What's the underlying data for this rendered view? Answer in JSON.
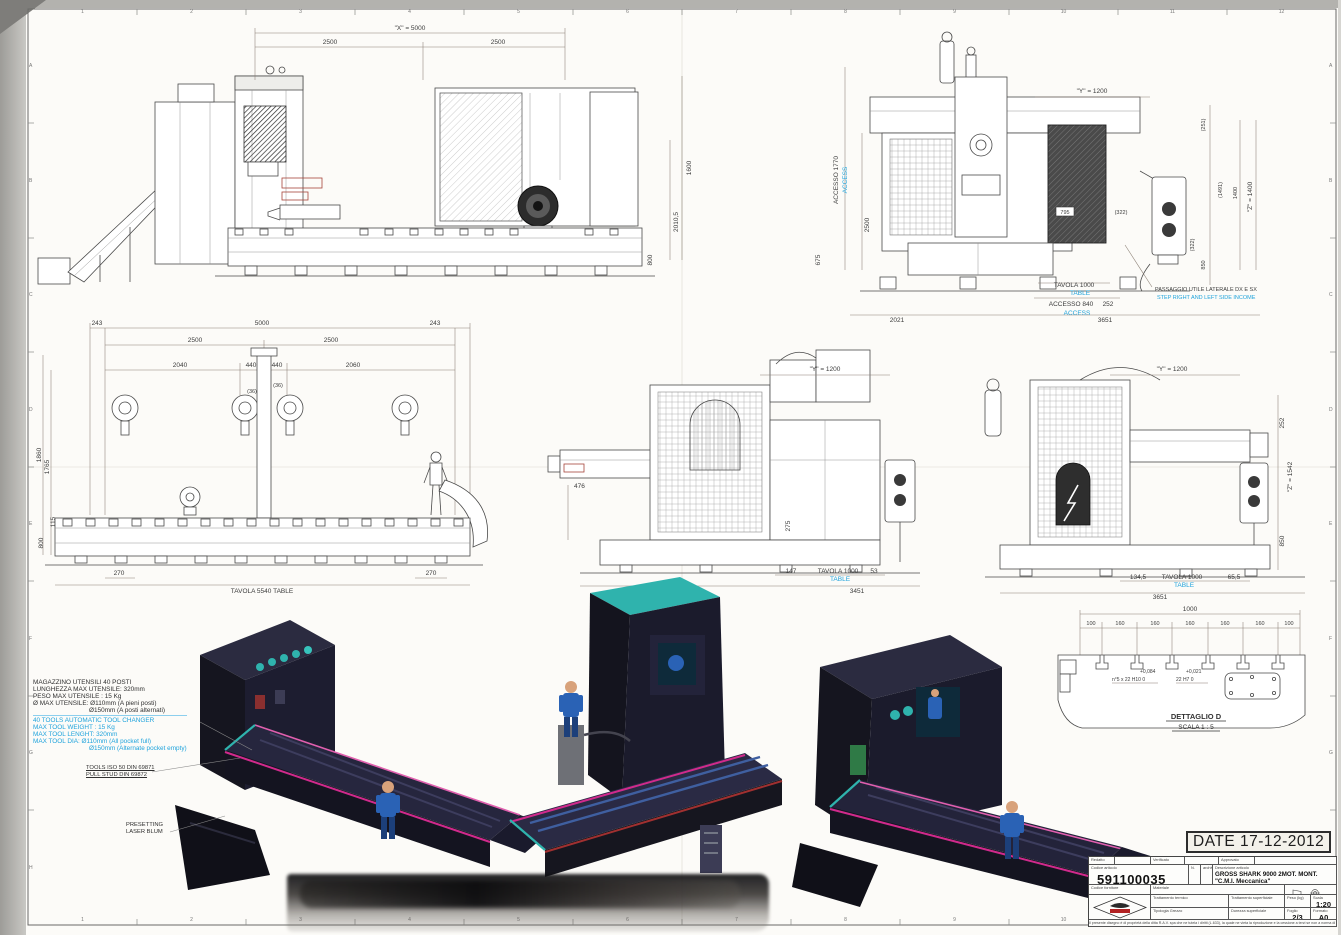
{
  "sheet": {
    "date_stamp": "DATE 17-12-2012",
    "zones_top": [
      "1",
      "2",
      "3",
      "4",
      "5",
      "6",
      "7",
      "8",
      "9",
      "10",
      "11",
      "12"
    ],
    "zones_bottom": [
      "1",
      "2",
      "3",
      "4",
      "5",
      "6",
      "7",
      "8",
      "9",
      "10",
      "11",
      "12"
    ],
    "zones_left": [
      "A",
      "B",
      "C",
      "D",
      "E",
      "F",
      "G",
      "H"
    ],
    "zones_right": [
      "A",
      "B",
      "C",
      "D",
      "E",
      "F",
      "G",
      "H"
    ]
  },
  "notes": {
    "magazine_it": [
      "MAGAZZINO UTENSILI 40 POSTI",
      "LUNGHEZZA MAX UTENSILE: 320mm",
      "PESO MAX UTENSILE : 15 Kg",
      "Ø MAX UTENSILE:  Ø110mm (A pieni posti)",
      "Ø150mm (A posti alternati)"
    ],
    "magazine_en": [
      "40 TOOLS AUTOMATIC TOOL CHANGER",
      "MAX TOOL  WEIGHT : 15 Kg",
      "MAX TOOL LENGHT: 320mm",
      "MAX TOOL DIA:  Ø110mm (All pocket full)",
      "Ø150mm (Alternate pocket empty)"
    ],
    "tools_iso": [
      "TOOLS ISO 50 DIN 69871",
      "PULL STUD DIN 69872"
    ],
    "presetting": [
      "PRESETTING",
      "LASER BLUM"
    ]
  },
  "view_tl": {
    "dim_total": "\"X\" = 5000",
    "dim_left": "2500",
    "dim_right": "2500",
    "dim_v1": "1600",
    "dim_v2": "2010,5",
    "dim_v3": "800"
  },
  "view_tr": {
    "dim_y": "\"Y\" = 1200",
    "accesso_v": "ACCESSO 1770",
    "access_v": "ACCESS",
    "dim_2500": "2500",
    "dim_675": "675",
    "dim_251": "(251)",
    "dim_1491": "(1491)",
    "dim_1400": "1400",
    "dim_z": "\"Z\" = 1400",
    "dim_322": "(322)",
    "dim_850": "850",
    "dim_795": "795",
    "dim_322b": "(322)",
    "tavola": "TAVOLA 1000",
    "table": "TABLE",
    "accesso": "ACCESSO 840",
    "access": "ACCESS",
    "dim_252": "252",
    "dim_2021": "2021",
    "dim_3651": "3651",
    "note_it": "PASSAGGIO UTILE LATERALE DX E SX",
    "note_en": "STEP RIGHT AND LEFT SIDE INCOME"
  },
  "view_ml": {
    "r1": [
      "243",
      "5000",
      "243"
    ],
    "r2": [
      "2500",
      "2500"
    ],
    "r3": [
      "2040",
      "440",
      "440",
      "2060"
    ],
    "r4": [
      "(36)",
      "(36)"
    ],
    "left": [
      "1860",
      "1765",
      "800",
      "115"
    ],
    "b270l": "270",
    "b270r": "270",
    "table": "TAVOLA 5540 TABLE"
  },
  "view_mc": {
    "dim_y": "\"Y\" = 1200",
    "dim_476": "476",
    "dim_275": "275",
    "dim_147": "147",
    "tavola": "TAVOLA 1000",
    "table": "TABLE",
    "dim_53": "53",
    "dim_2021": "2021",
    "dim_3451": "3451"
  },
  "view_mr": {
    "dim_y": "\"Y\" = 1200",
    "dim_252": "252",
    "dim_z": "\"Z\" = 1542",
    "dim_850": "850",
    "dim_134": "134,5",
    "tavola": "TAVOLA 1000",
    "table": "TABLE",
    "dim_65": "65,5",
    "dim_3651": "3651"
  },
  "detail": {
    "dim_total": "1000",
    "dims": [
      "100",
      "160",
      "160",
      "160",
      "160",
      "160",
      "100"
    ],
    "tol1_sup": "+0,084",
    "tol1": "n°5 x 22 H10  0",
    "tol2_sup": "+0,021",
    "tol2": "22 H7  0",
    "title": "DETTAGLIO D",
    "scale": "SCALA 1 : 5"
  },
  "title_block": {
    "redatto": "Redatto",
    "verificato": "Verificato",
    "approvato": "Approvato",
    "codice_label": "Codice articolo",
    "codice": "591100035",
    "n_label": "N.",
    "archivio_label": "archivio",
    "descr_label": "Descrizione articolo",
    "descr1": "GROSS SHARK 9000 2MOT. MONT. \"C.M.I. Meccanica\"",
    "descr2": "LAY-OUT",
    "fornitore_label": "Codice fornitore",
    "materiale_label": "Materiale",
    "tratt_termico_label": "Trattamento termico",
    "tratt_sup_label": "Trattamento superficiale",
    "tipologia_label": "Tipologia Grezzo",
    "durezza_label": "Durezza superficiale",
    "peso_label": "Peso (kg)",
    "scala_label": "Scala",
    "scala": "1:20",
    "foglio_label": "Foglio",
    "foglio": "2/3",
    "formato_label": "Formato",
    "formato": "A0",
    "disclaimer": "Il presente disegno è di proprietà della ditta R.A.V. spa che ne tutela i diritti (L.633), la quale ne vieta la riproduzione e la cessione a terzi se non a norma di legge."
  }
}
